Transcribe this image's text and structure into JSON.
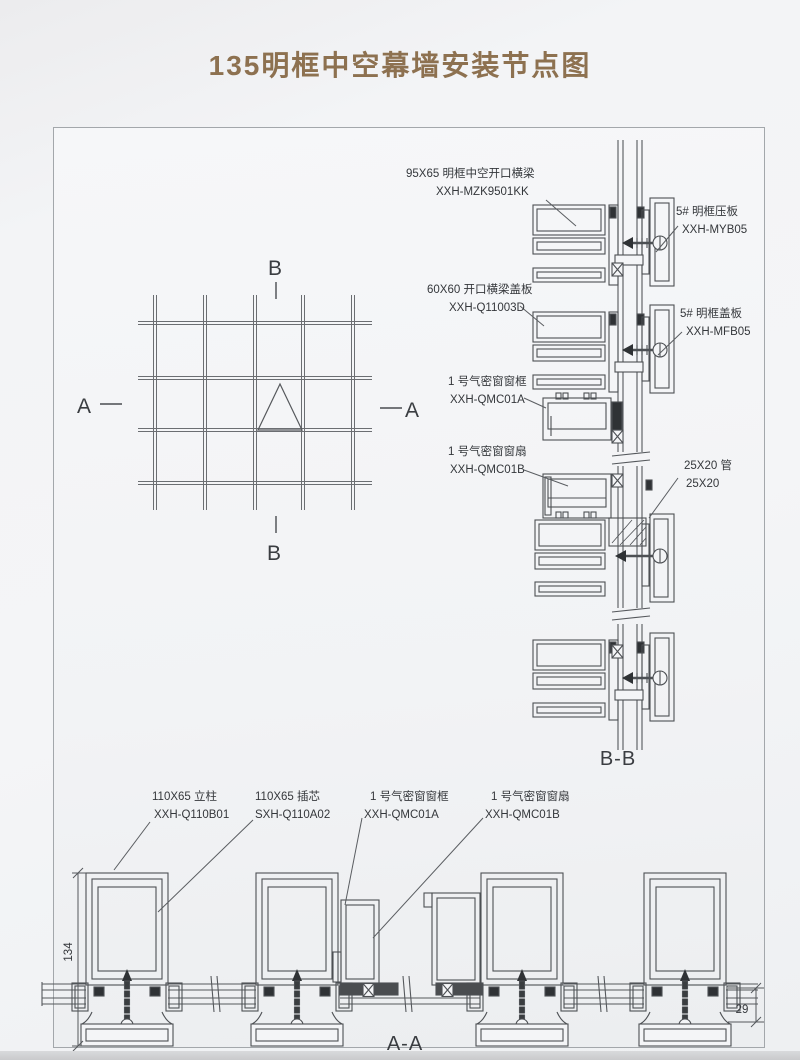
{
  "page": {
    "title": "135明框中空幕墙安装节点图"
  },
  "colors": {
    "title": "#8d7150",
    "line": "#4d5054",
    "dark_fill": "#2f3235",
    "text": "#34373b"
  },
  "plan": {
    "marker_a_left": "A",
    "marker_a_right": "A",
    "marker_b_top": "B",
    "marker_b_bottom": "B"
  },
  "section_bb": {
    "caption": "B-B",
    "labels": [
      {
        "line1": "95X65 明框中空开口横梁",
        "line2": "XXH-MZK9501KK"
      },
      {
        "line1": "5# 明框压板",
        "line2": "XXH-MYB05"
      },
      {
        "line1": "60X60 开口横梁盖板",
        "line2": "XXH-Q11003D"
      },
      {
        "line1": "5# 明框盖板",
        "line2": "XXH-MFB05"
      },
      {
        "line1": "1 号气密窗窗框",
        "line2": "XXH-QMC01A"
      },
      {
        "line1": "1 号气密窗窗扇",
        "line2": "XXH-QMC01B"
      },
      {
        "line1": "25X20 管",
        "line2": "25X20"
      }
    ]
  },
  "section_aa": {
    "caption": "A-A",
    "dim_left": "134",
    "dim_right": "29",
    "labels": [
      {
        "line1": "110X65 立柱",
        "line2": "XXH-Q110B01"
      },
      {
        "line1": "110X65 插芯",
        "line2": "SXH-Q110A02"
      },
      {
        "line1": "1 号气密窗窗框",
        "line2": "XXH-QMC01A"
      },
      {
        "line1": "1 号气密窗窗扇",
        "line2": "XXH-QMC01B"
      }
    ]
  }
}
